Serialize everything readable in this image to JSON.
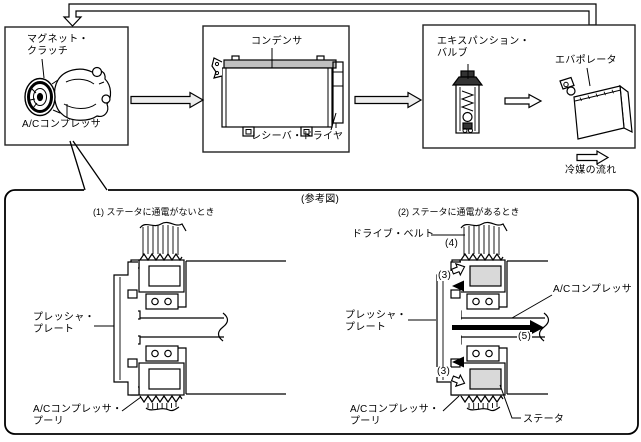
{
  "flow": {
    "box1": {
      "label_clutch": "マグネット・\nクラッチ",
      "label_compressor": "A/Cコンプレッサ"
    },
    "box2": {
      "label_condenser": "コンデンサ",
      "label_receiver_drier": "レシーバ・ドライヤ"
    },
    "box3": {
      "label_expansion_valve": "エキスパンション・\nバルブ",
      "label_evaporator": "エバポレータ"
    },
    "legend": "冷媒の流れ"
  },
  "ref": {
    "title": "(参考図)",
    "fig1": {
      "caption": "(1) ステータに通電がないとき",
      "pressure_plate": "プレッシャ・\nプレート",
      "pulley": "A/Cコンプレッサ・\nプーリ"
    },
    "fig2": {
      "caption": "(2) ステータに通電があるとき",
      "drive_belt": "ドライブ・ベルト",
      "n4": "(4)",
      "n3_upper": "(3)",
      "n3_lower": "(3)",
      "n5": "(5)",
      "compressor": "A/Cコンプレッサ",
      "pressure_plate": "プレッシャ・\nプレート",
      "pulley": "A/Cコンプレッサ・\nプーリ",
      "stator": "ステータ"
    }
  },
  "colors": {
    "line": "#000000",
    "box_border": "#222222",
    "coil_fill": "#d9d9d9",
    "arrow_fill": "#ededed",
    "condenser_header": "#c0c0c0"
  }
}
